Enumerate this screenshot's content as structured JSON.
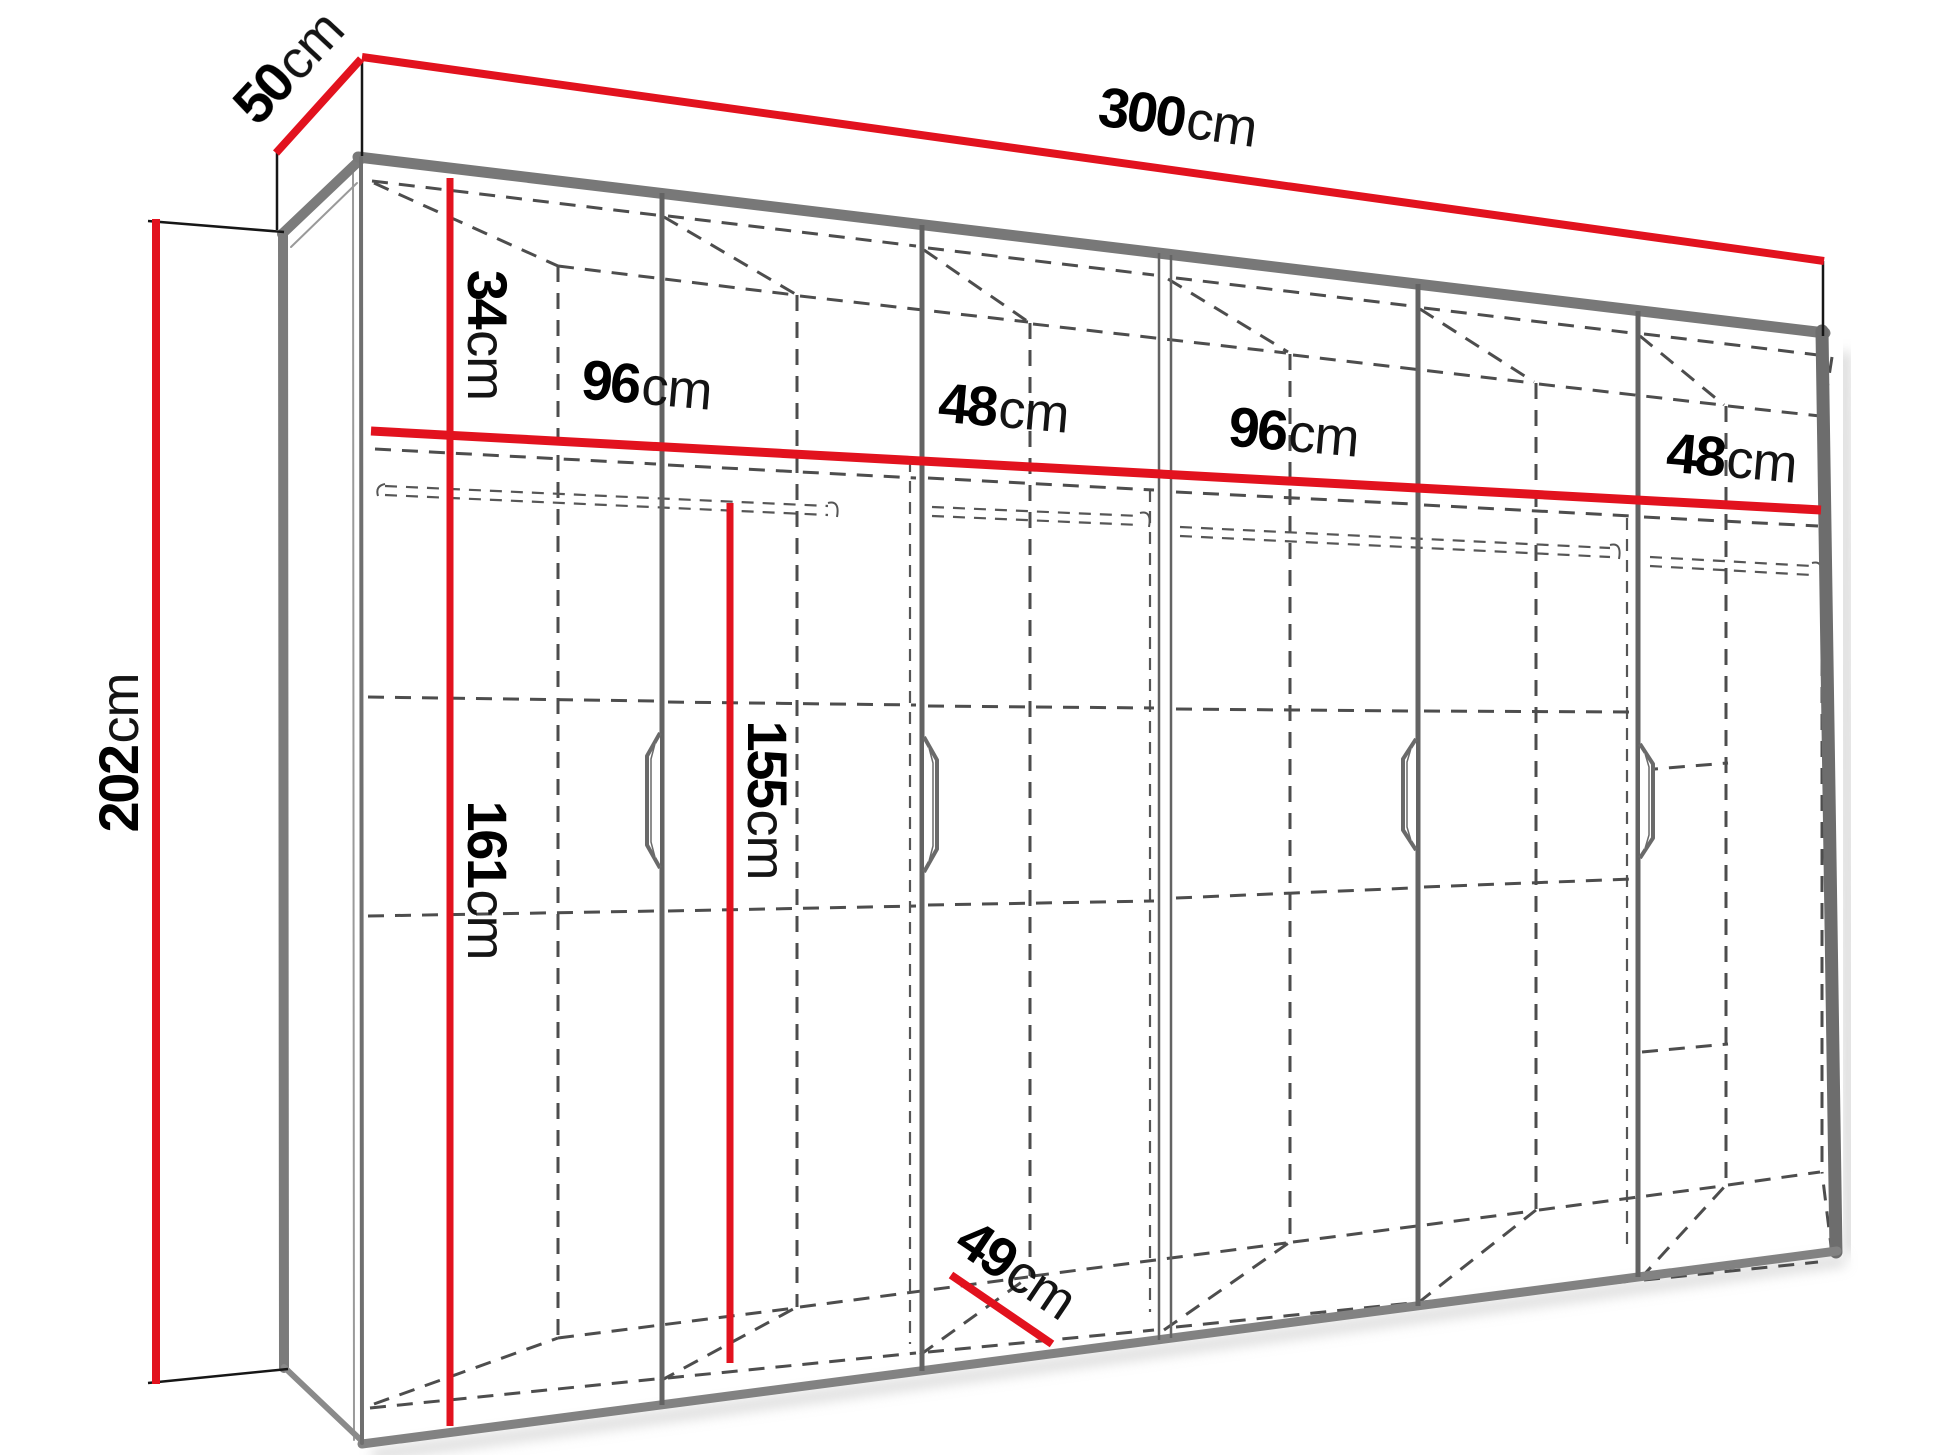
{
  "diagram": {
    "kind": "wardrobe-dimension-drawing",
    "unit": "cm",
    "overall": {
      "width": {
        "num": "300",
        "unit": "cm"
      },
      "depth": {
        "num": "50",
        "unit": "cm"
      },
      "height": {
        "num": "202",
        "unit": "cm"
      }
    },
    "interior": {
      "top_shelf_drop": {
        "num": "34",
        "unit": "cm"
      },
      "hanging_left": {
        "num": "161",
        "unit": "cm"
      },
      "hanging_middle": {
        "num": "155",
        "unit": "cm"
      },
      "floor_depth": {
        "num": "49",
        "unit": "cm"
      }
    },
    "sections": [
      {
        "num": "96",
        "unit": "cm"
      },
      {
        "num": "48",
        "unit": "cm"
      },
      {
        "num": "96",
        "unit": "cm"
      },
      {
        "num": "48",
        "unit": "cm"
      }
    ],
    "colors": {
      "dimension_red": "#e2121e",
      "carcass_gray": "#787878",
      "hidden_line_gray": "#4d4d4d",
      "text_black": "#000000",
      "background": "#ffffff"
    }
  }
}
